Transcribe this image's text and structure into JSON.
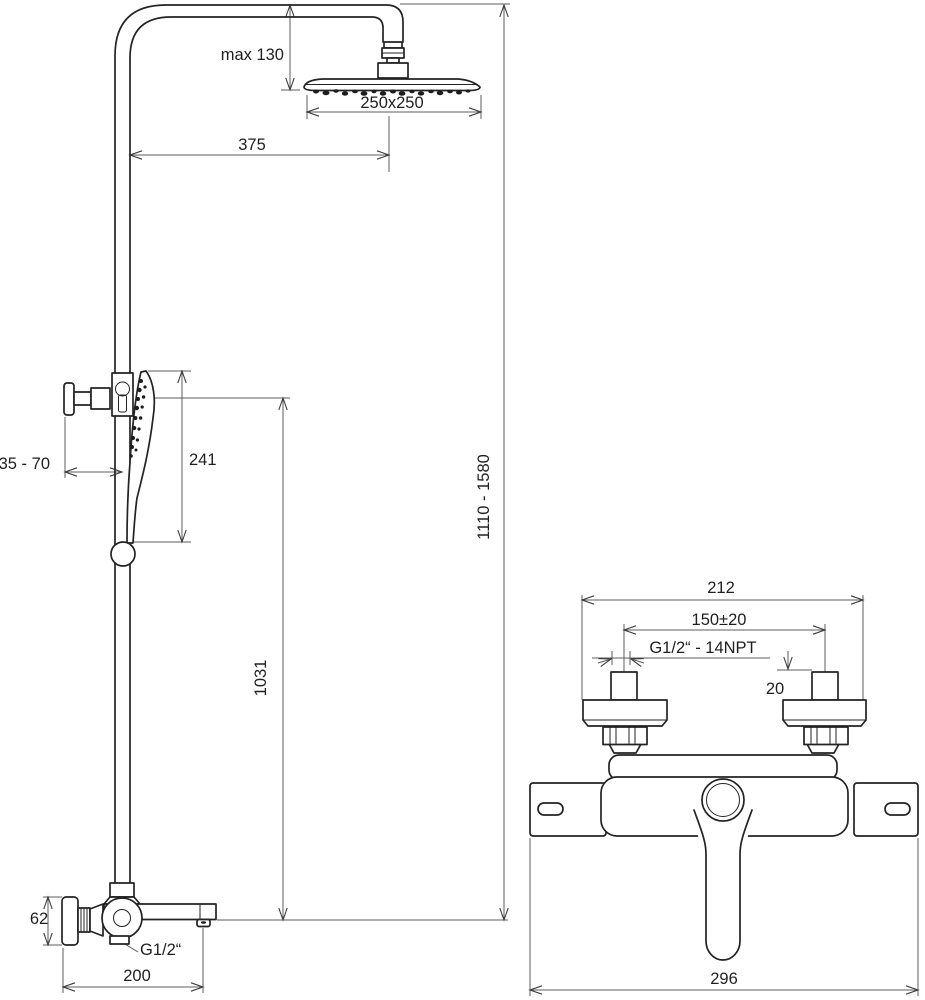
{
  "drawing_title": "Shower column and bath mixer dimensional drawing",
  "left_figure": {
    "name": "shower-column",
    "dims": {
      "head_drop_max": "max 130",
      "head_size": "250x250",
      "arm_projection": "375",
      "hand_shower_length": "241",
      "wall_clearance": "35 - 70",
      "bar_height": "1031",
      "overall_height": "1110 - 1580",
      "mixer_body_height": "62",
      "hose_thread": "G1/2“",
      "spout_projection": "200"
    }
  },
  "right_figure": {
    "name": "bath-mixer",
    "dims": {
      "body_width": "212",
      "connection_centers": "150±20",
      "connection_thread": "G1/2“ - 14NPT",
      "stub_size": "20",
      "overall_width": "296"
    }
  },
  "colors": {
    "object_line": "#232323",
    "dimension_line": "#5c5c5c",
    "background": "#ffffff"
  }
}
